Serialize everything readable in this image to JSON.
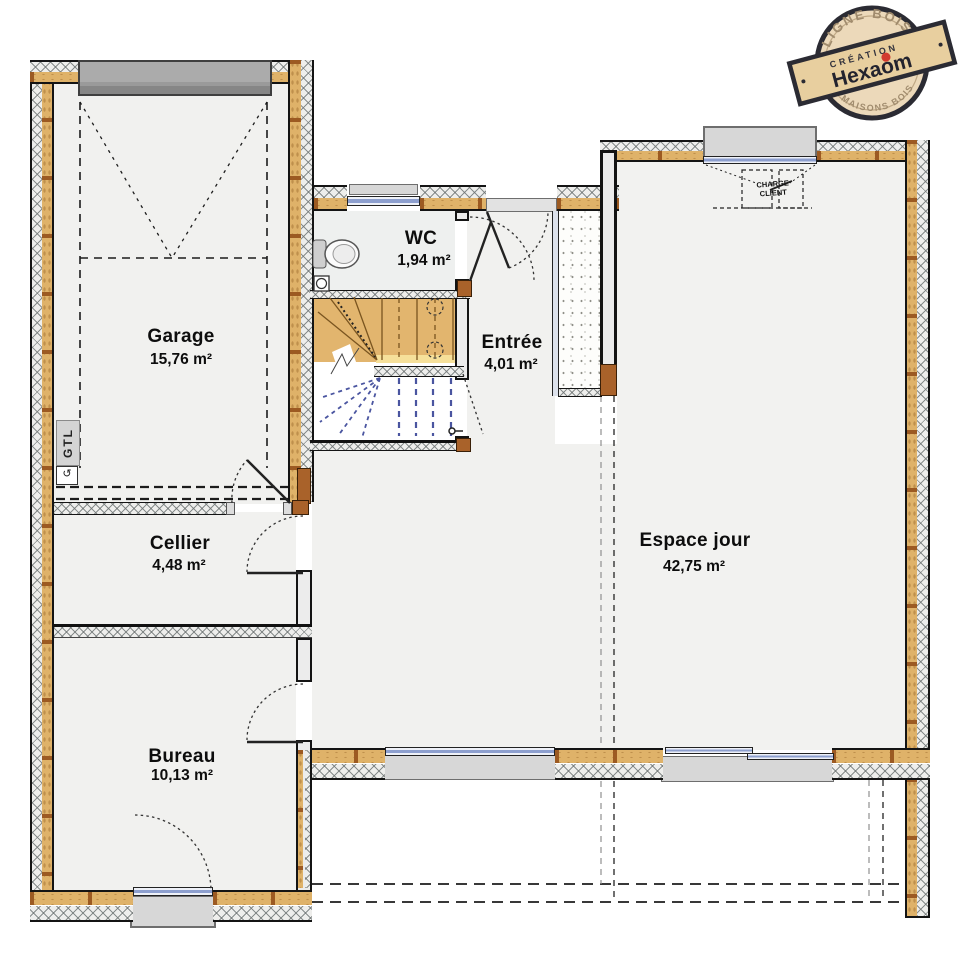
{
  "rooms": [
    {
      "id": "garage",
      "name": "Garage",
      "area": "15,76 m²"
    },
    {
      "id": "wc",
      "name": "WC",
      "area": "1,94 m²"
    },
    {
      "id": "entree",
      "name": "Entrée",
      "area": "4,01 m²"
    },
    {
      "id": "cellier",
      "name": "Cellier",
      "area": "4,48 m²"
    },
    {
      "id": "bureau",
      "name": "Bureau",
      "area": "10,13 m²"
    },
    {
      "id": "espace_jour",
      "name": "Espace jour",
      "area": "42,75 m²"
    }
  ],
  "annotations": {
    "gtl": "GTL",
    "vent_symbol": "↺",
    "charge_line1": "CHARGE",
    "charge_line2": "CLIENT"
  },
  "stamp": {
    "top_arc": "LIGNE BOIS",
    "bottom_arc": "MAISONS BOIS",
    "creation": "CRÉATION",
    "brand": "Hexaom"
  },
  "colors": {
    "timber_layer": "#dfb269",
    "timber_stud": "#9c5a22",
    "hatch_bg": "#eeeeec",
    "glass_blue": "#8d9fce",
    "window_sill": "#d7d7d7",
    "garage_door": "#9a9a9a",
    "stair_wood": "#e2b56e",
    "stair_dash_blue": "#4a55a0",
    "door_frame_brown": "#a9622a",
    "stamp_red": "#d23b2f",
    "stamp_ink": "#2b2b33",
    "stamp_wood": "#ecd9ba"
  }
}
